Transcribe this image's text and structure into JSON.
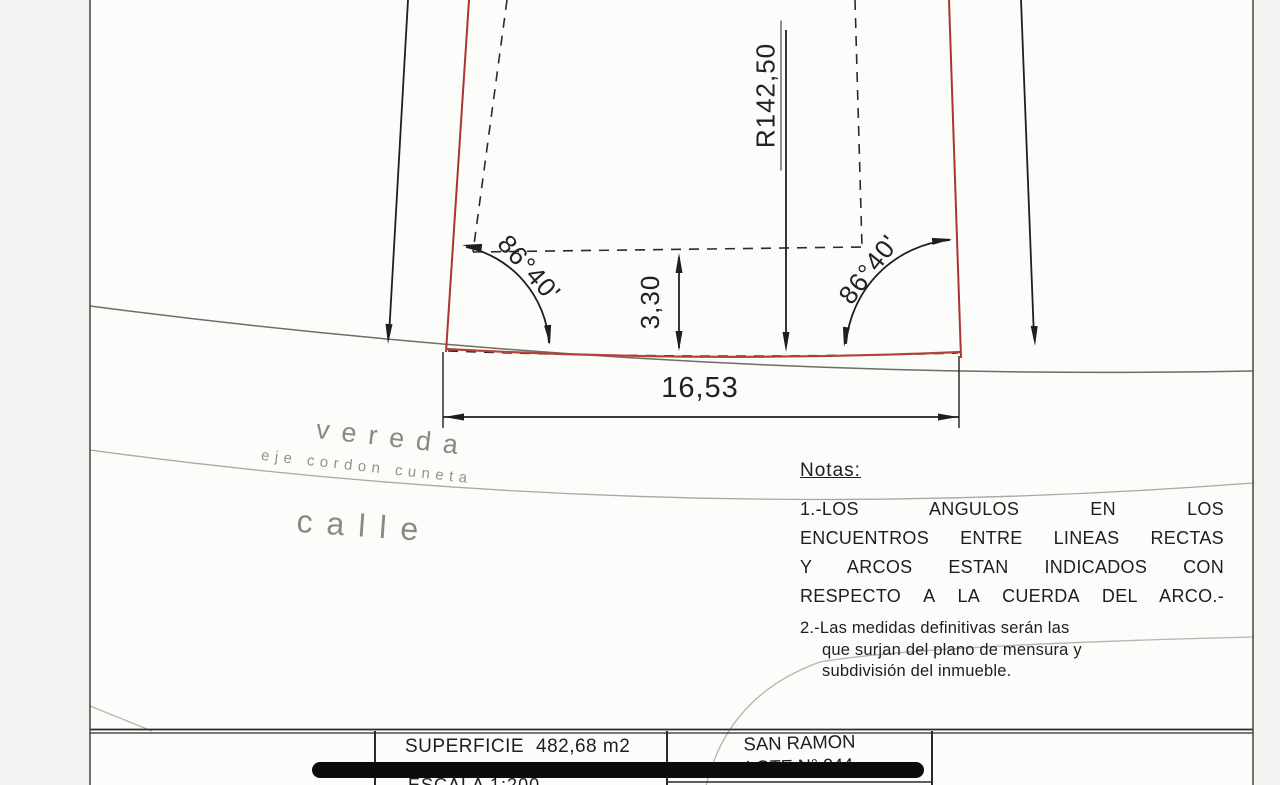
{
  "drawing": {
    "radius_dimension": "R142,50",
    "left_angle": "86°40'",
    "right_angle": "86°40'",
    "offset_dimension": "3,30",
    "frontage_dimension": "16,53"
  },
  "street": {
    "vereda": "vereda",
    "eje_cordon_cuneta": "eje cordon cuneta",
    "calle": "calle"
  },
  "notes": {
    "title": "Notas:",
    "note1": [
      "1.-LOS ANGULOS EN LOS",
      "ENCUENTROS ENTRE LINEAS RECTAS",
      "Y ARCOS ESTAN INDICADOS CON",
      "RESPECTO A LA CUERDA DEL ARCO.-"
    ],
    "note2": [
      "2.-Las medidas definitivas serán las",
      "que surjan del plano de mensura y",
      "subdivisión del inmueble."
    ]
  },
  "title_block": {
    "superficie_label": "SUPERFICIE",
    "superficie_value": "482,68 m2",
    "escala": "ESCALA 1:200",
    "locality": "SAN RAMON",
    "lote": "LOTE N° 244"
  },
  "colors": {
    "boundary_red": "#a93531",
    "line_black": "#1f1f1f",
    "street_gray": "#8a8981"
  }
}
